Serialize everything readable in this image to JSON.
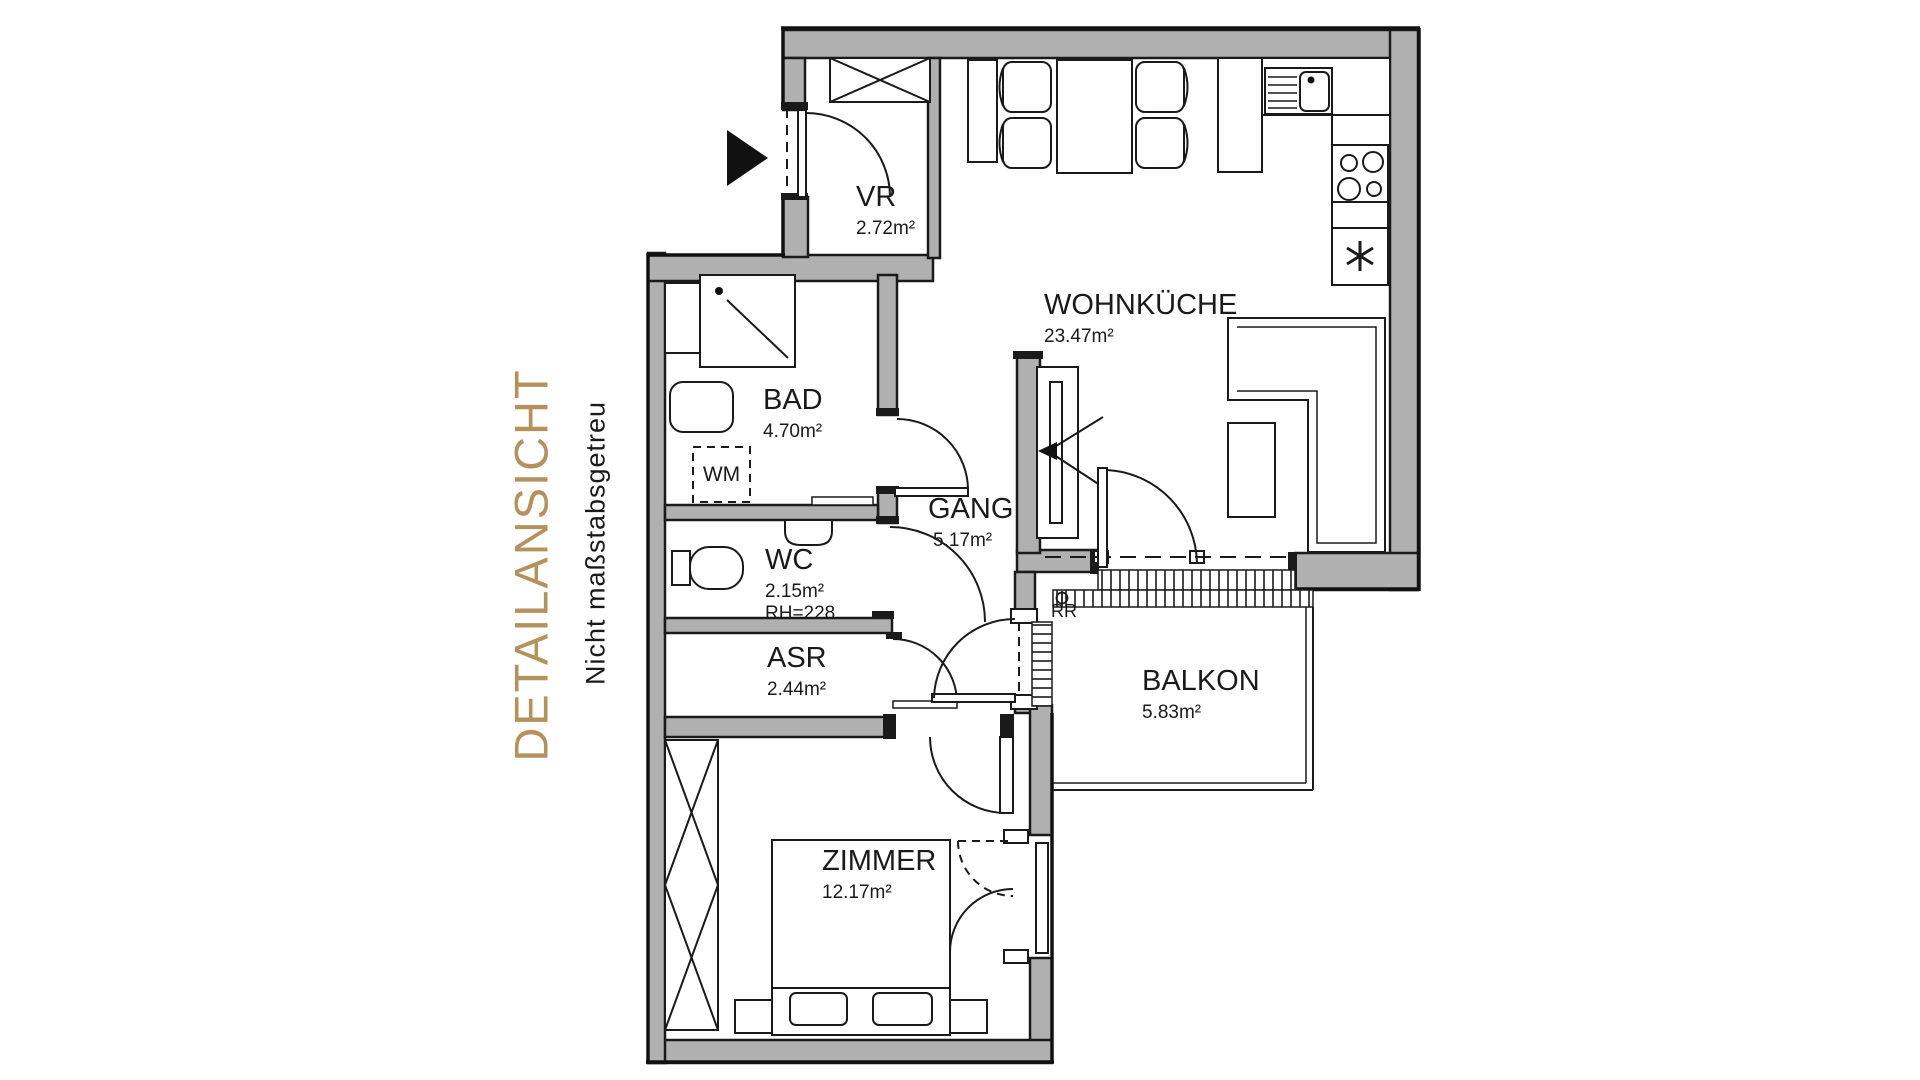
{
  "sidebar": {
    "title": "DETAILANSICHT",
    "subtitle": "Nicht maßstabsgetreu",
    "title_color": "#b3925e"
  },
  "rooms": {
    "vr": {
      "name": "VR",
      "area": "2.72m²"
    },
    "wohnkueche": {
      "name": "WOHNKÜCHE",
      "area": "23.47m²"
    },
    "bad": {
      "name": "BAD",
      "area": "4.70m²"
    },
    "gang": {
      "name": "GANG",
      "area": "5.17m²"
    },
    "wc": {
      "name": "WC",
      "area": "2.15m²",
      "room_height": "RH=228"
    },
    "asr": {
      "name": "ASR",
      "area": "2.44m²"
    },
    "zimmer": {
      "name": "ZIMMER",
      "area": "12.17m²"
    },
    "balkon": {
      "name": "BALKON",
      "area": "5.83m²"
    }
  },
  "annotations": {
    "washing_machine": "WM",
    "rain_pipe": "RR"
  },
  "colors": {
    "wall_fill": "#b0b0b0",
    "line": "#1a1a1a",
    "accent_gold": "#b3925e",
    "background": "#ffffff"
  }
}
